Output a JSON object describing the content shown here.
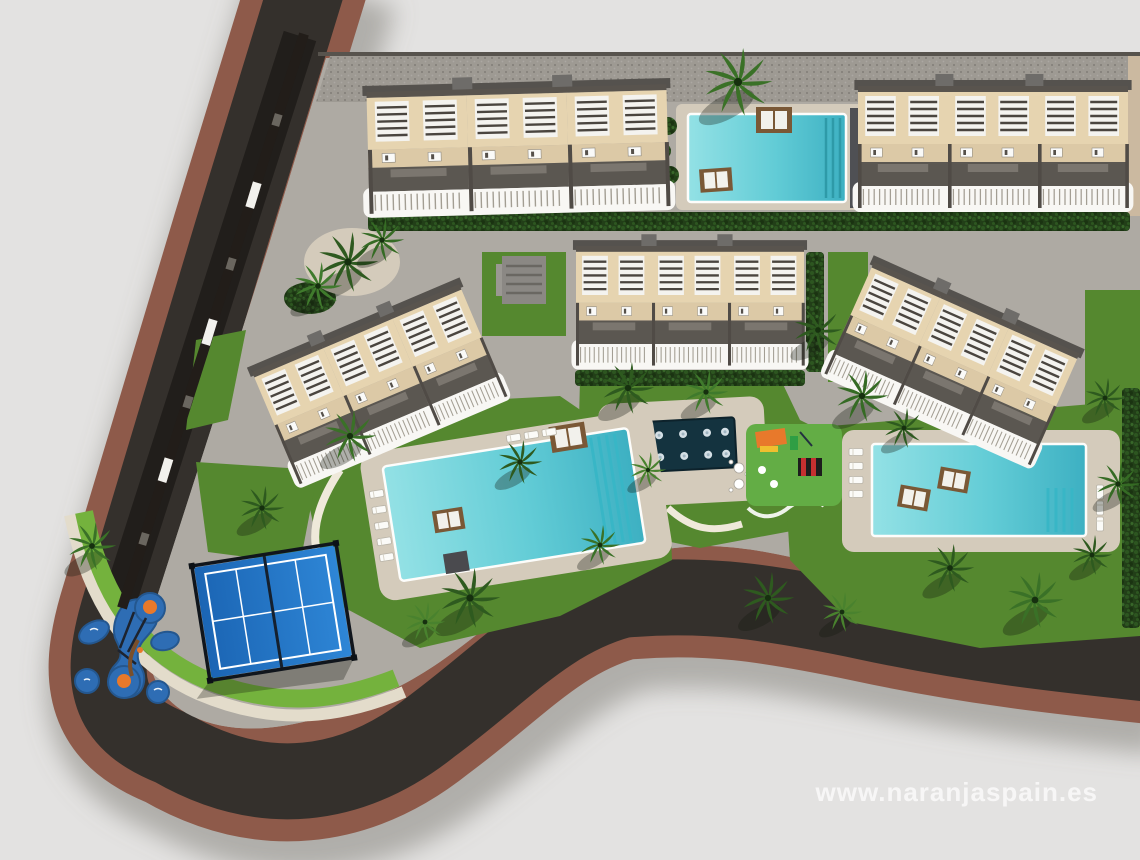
{
  "image": {
    "kind": "aerial-3d-site-plan-render",
    "watermark": "www.naranjaspain.es"
  },
  "palette": {
    "background": "#e3e2e1",
    "road-asphalt": "#34302c",
    "road-sidewalk": "#8e5a4a",
    "paving": "#aeaaa3",
    "paving-dark": "#9e9a93",
    "deck": "#d4cbbb",
    "grass": "#55882f",
    "grass-bright": "#74b23d",
    "hedge-green": "#223f18",
    "pool-shallow": "#8adde2",
    "pool-deep": "#3db0c2",
    "building-wall": "#e6d4b0",
    "building-terrace": "#dcc9a6",
    "building-roof": "#5b5751",
    "railing-white": "#f8f7f4",
    "court-blue": "#1f72c4",
    "playground-blue": "#2e6db4",
    "accent-orange": "#e8792b",
    "fountain-basin": "#14333f",
    "wood-brown": "#7a5836",
    "watermark-color": "#ffffff"
  },
  "scene": {
    "building_rows": 5,
    "swimming_pools": 3,
    "splash_fountains": 1,
    "playgrounds": 2,
    "paddle_courts": 1
  }
}
